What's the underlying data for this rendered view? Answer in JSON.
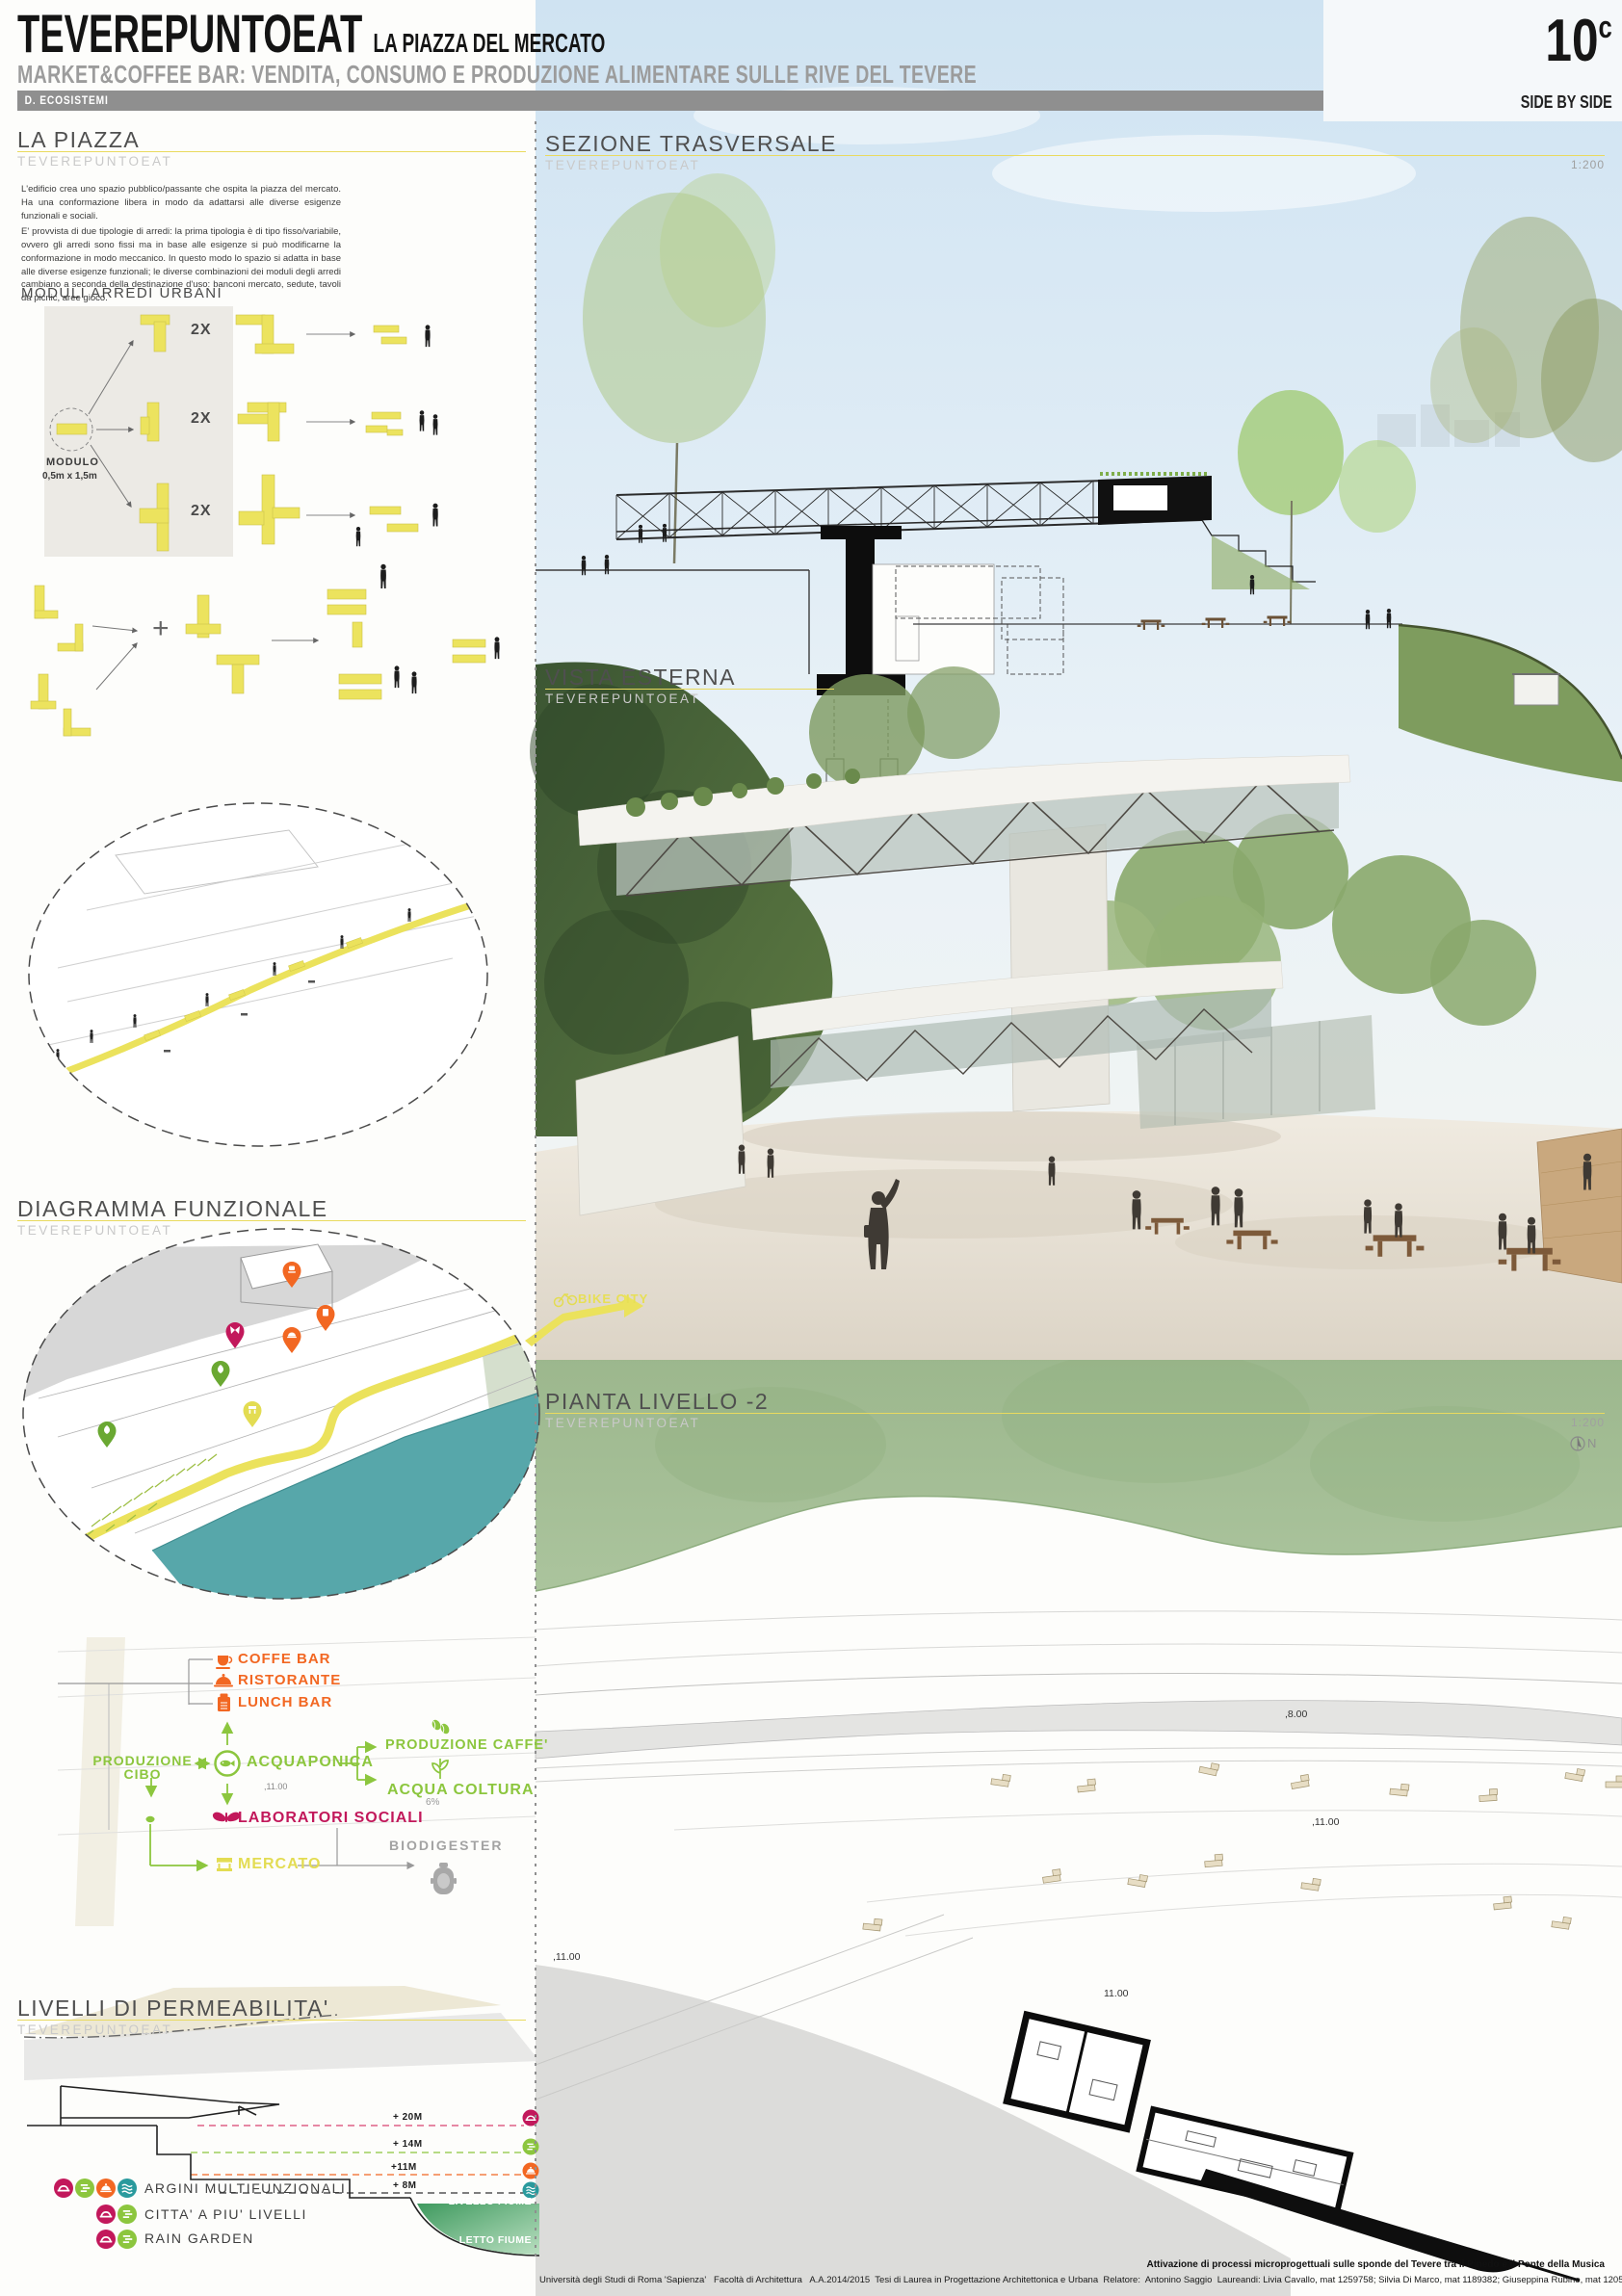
{
  "header": {
    "title": "TEVEREPUNTOEAT",
    "title_suffix": "LA PIAZZA DEL MERCATO",
    "subtitle": "MARKET&COFFEE BAR: VENDITA, CONSUMO E PRODUZIONE ALIMENTARE SULLE RIVE DEL TEVERE",
    "category": "D. ECOSISTEMI",
    "board_number": "10",
    "board_letter": "c",
    "series": "SIDE BY SIDE"
  },
  "sections": {
    "la_piazza": {
      "title": "LA PIAZZA",
      "sub": "TEVEREPUNTOEAT"
    },
    "moduli": {
      "title": "MODULI ARREDI URBANI"
    },
    "sezione": {
      "title": "SEZIONE TRASVERSALE",
      "sub": "TEVEREPUNTOEAT",
      "scale": "1:200"
    },
    "vista": {
      "title": "VISTA ESTERNA",
      "sub": "TEVEREPUNTOEAT"
    },
    "pianta": {
      "title": "PIANTA LIVELLO -2",
      "sub": "TEVEREPUNTOEAT",
      "scale": "1:200",
      "north": "N"
    },
    "diagramma": {
      "title": "DIAGRAMMA FUNZIONALE",
      "sub": "TEVEREPUNTOEAT"
    },
    "livelli": {
      "title": "LIVELLI DI PERMEABILITA'",
      "sub": "TEVEREPUNTOEAT"
    }
  },
  "intro": {
    "p1": "L'edificio crea uno spazio pubblico/passante che ospita la piazza del mercato. Ha una conformazione libera in modo da adattarsi alle diverse esigenze funzionali e sociali.",
    "p2": "E' provvista di due tipologie di arredi: la prima tipologia è di tipo fisso/variabile, ovvero gli arredi sono fissi ma in base alle esigenze si può modificarne la conformazione in modo meccanico. In questo modo lo spazio si adatta in base alle diverse esigenze funzionali; le diverse combinazioni dei moduli degli arredi cambiano a seconda della destinazione d'uso: banconi mercato, sedute, tavoli da picnic, aree gioco."
  },
  "moduli": {
    "modulo_label": "MODULO",
    "modulo_size": "0,5m x 1,5m",
    "multiplier": "2X",
    "plus": "+"
  },
  "bike_city": "BIKE CITY",
  "flow": {
    "coffe_bar": "COFFE BAR",
    "ristorante": "RISTORANTE",
    "lunch_bar": "LUNCH BAR",
    "produzione_line1": "PRODUZIONE",
    "produzione_line2": "CIBO",
    "acquaponica": "ACQUAPONICA",
    "acquaponica_level": ",11.00",
    "produzione_caffe": "PRODUZIONE CAFFE'",
    "acqua_coltura": "ACQUA COLTURA",
    "acqua_pct": "6%",
    "laboratori": "LABORATORI SOCIALI",
    "mercato": "MERCATO",
    "biodigester": "BIODIGESTER"
  },
  "levels": {
    "l20": "+ 20M",
    "l14": "+ 14M",
    "l11": "+11M",
    "l8": "+ 8M",
    "livello": "LIVELLO FIUME",
    "letto": "LETTO FIUME"
  },
  "legend": {
    "items": [
      "ARGINI MULTIFUNZIONALI",
      "CITTA' A PIU' LIVELLI",
      "RAIN GARDEN"
    ]
  },
  "plan_labels": {
    "l8": ",8.00",
    "l11a": ",11.00",
    "l11b": "11.00",
    "l11c": ",11.00"
  },
  "footer": {
    "line1": "Attivazione di processi microprogettuali sulle sponde del Tevere tra il Pinedo e il Ponte della Musica",
    "line2": "Università degli Studi di Roma 'Sapienza'   Facoltà di Architettura   A.A.2014/2015  Tesi di Laurea in Progettazione Architettonica e Urbana  Relatore:  Antonino Saggio  Laureandi: Livia Cavallo, mat 1259758; Silvia Di Marco, mat 1189382; Giuseppina Rubino, mat 1205370"
  },
  "colors": {
    "yellow": "#ece35e",
    "orange": "#f26722",
    "green": "#8cc63e",
    "magenta": "#c2185b",
    "teal_river": "#57a7aa",
    "teal_icon": "#2a9a9d",
    "gray_bar": "#8f8f8f"
  }
}
